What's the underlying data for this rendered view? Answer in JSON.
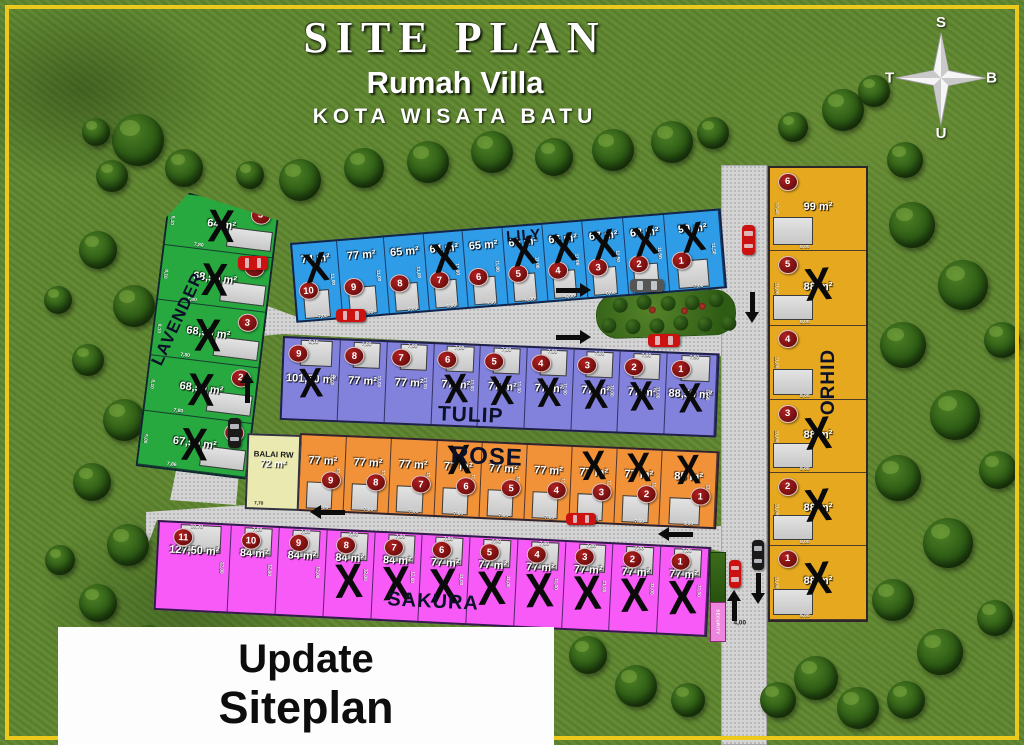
{
  "title": {
    "main": "SITE PLAN",
    "sub": "Rumah Villa",
    "location": "KOTA WISATA BATU"
  },
  "compass": {
    "top": "S",
    "bottom": "U",
    "left": "T",
    "right": "B"
  },
  "update_overlay": {
    "line1": "Update",
    "line2": "Siteplan"
  },
  "facility": {
    "name": "BALAI RW",
    "area": "72 m²",
    "frontage": "7,70"
  },
  "security_post_label": "SECURITY",
  "road_width_label": "4,00",
  "sold_marker": "X",
  "blocks": [
    {
      "id": "lily",
      "name": "LILY",
      "color": "#2f9ce8",
      "lots": [
        {
          "no": "10",
          "area": "74 m²",
          "sold": true,
          "f": "7,00",
          "d": "11,00"
        },
        {
          "no": "9",
          "area": "77 m²",
          "sold": false,
          "f": "7,00",
          "d": "11,00"
        },
        {
          "no": "8",
          "area": "65 m²",
          "sold": false,
          "f": "6,00",
          "d": "11,00"
        },
        {
          "no": "7",
          "area": "64 m²",
          "sold": true,
          "f": "6,00",
          "d": "11,00"
        },
        {
          "no": "6",
          "area": "65 m²",
          "sold": false,
          "f": "6,00",
          "d": "11,00"
        },
        {
          "no": "5",
          "area": "65 m²",
          "sold": true,
          "f": "6,00",
          "d": "11,00"
        },
        {
          "no": "4",
          "area": "66 m²",
          "sold": true,
          "f": "6,00",
          "d": "11,00"
        },
        {
          "no": "3",
          "area": "67 m²",
          "sold": true,
          "f": "6,00",
          "d": "11,50"
        },
        {
          "no": "2",
          "area": "68 m²",
          "sold": true,
          "f": "6,00",
          "d": "11,50"
        },
        {
          "no": "1",
          "area": "90 m²",
          "sold": true,
          "f": "7,00",
          "d": "11,50"
        }
      ]
    },
    {
      "id": "tulip",
      "name": "TULIP",
      "color": "#8282dd",
      "lots": [
        {
          "no": "9",
          "area": "101,50 m²",
          "sold": true,
          "f": "8,10",
          "d": "11,00"
        },
        {
          "no": "8",
          "area": "77 m²",
          "sold": false,
          "f": "7,00",
          "d": "11,00"
        },
        {
          "no": "7",
          "area": "77 m²",
          "sold": false,
          "f": "7,00",
          "d": "11,00"
        },
        {
          "no": "6",
          "area": "77 m²",
          "sold": true,
          "f": "7,00",
          "d": "11,00"
        },
        {
          "no": "5",
          "area": "77 m²",
          "sold": true,
          "f": "7,00",
          "d": "11,00"
        },
        {
          "no": "4",
          "area": "77 m²",
          "sold": true,
          "f": "7,00",
          "d": "11,00"
        },
        {
          "no": "3",
          "area": "77 m²",
          "sold": true,
          "f": "7,00",
          "d": "11,00"
        },
        {
          "no": "2",
          "area": "77 m²",
          "sold": true,
          "f": "7,00",
          "d": "11,00"
        },
        {
          "no": "1",
          "area": "88,50 m²",
          "sold": true,
          "f": "7,50",
          "d": "11,00"
        }
      ]
    },
    {
      "id": "rose",
      "name": "ROSE",
      "color": "#f29238",
      "lots": [
        {
          "no": "9",
          "area": "77 m²",
          "sold": false,
          "f": "7,00",
          "d": "11,00"
        },
        {
          "no": "8",
          "area": "77 m²",
          "sold": false,
          "f": "7,00",
          "d": "11,00"
        },
        {
          "no": "7",
          "area": "77 m²",
          "sold": false,
          "f": "7,00",
          "d": "11,00"
        },
        {
          "no": "6",
          "area": "77 m²",
          "sold": true,
          "f": "7,00",
          "d": "11,00"
        },
        {
          "no": "5",
          "area": "77 m²",
          "sold": false,
          "f": "7,00",
          "d": "11,00"
        },
        {
          "no": "4",
          "area": "77 m²",
          "sold": false,
          "f": "7,00",
          "d": "11,00"
        },
        {
          "no": "3",
          "area": "77 m²",
          "sold": true,
          "f": "7,00",
          "d": "11,00"
        },
        {
          "no": "2",
          "area": "77 m²",
          "sold": true,
          "f": "7,00",
          "d": "11,00"
        },
        {
          "no": "1",
          "area": "85 m²",
          "sold": true,
          "f": "8,00",
          "d": "11,00"
        }
      ]
    },
    {
      "id": "sakura",
      "name": "SAKURA",
      "color": "#f75af7",
      "lots": [
        {
          "no": "11",
          "area": "127,50 m²",
          "sold": false,
          "f": "10,70",
          "d": "12,00"
        },
        {
          "no": "10",
          "area": "84 m²",
          "sold": false,
          "f": "7,00",
          "d": "12,00"
        },
        {
          "no": "9",
          "area": "84 m²",
          "sold": false,
          "f": "7,00",
          "d": "12,00"
        },
        {
          "no": "8",
          "area": "84 m²",
          "sold": true,
          "f": "7,00",
          "d": "12,00"
        },
        {
          "no": "7",
          "area": "84 m²",
          "sold": true,
          "f": "7,00",
          "d": "12,00"
        },
        {
          "no": "6",
          "area": "77 m²",
          "sold": true,
          "f": "7,00",
          "d": "11,00"
        },
        {
          "no": "5",
          "area": "77 m²",
          "sold": true,
          "f": "7,00",
          "d": "11,00"
        },
        {
          "no": "4",
          "area": "77 m²",
          "sold": true,
          "f": "7,00",
          "d": "11,00"
        },
        {
          "no": "3",
          "area": "77 m²",
          "sold": true,
          "f": "7,00",
          "d": "11,00"
        },
        {
          "no": "2",
          "area": "77 m²",
          "sold": true,
          "f": "7,00",
          "d": "11,00"
        },
        {
          "no": "1",
          "area": "77 m²",
          "sold": true,
          "f": "7,00",
          "d": "11,00"
        }
      ]
    },
    {
      "id": "lavender",
      "name": "LAVENDER",
      "color": "#27a93f",
      "lots": [
        {
          "no": "5",
          "area": "64 m²",
          "sold": true,
          "f": "7,80",
          "d": "8,10"
        },
        {
          "no": "4",
          "area": "68,50 m²",
          "sold": true,
          "f": "7,80",
          "d": "8,10"
        },
        {
          "no": "3",
          "area": "68,50 m²",
          "sold": true,
          "f": "7,80",
          "d": "8,10"
        },
        {
          "no": "2",
          "area": "68,50 m²",
          "sold": true,
          "f": "7,80",
          "d": "8,10"
        },
        {
          "no": "1",
          "area": "67,50 m²",
          "sold": true,
          "f": "7,86",
          "d": "5,00"
        }
      ]
    },
    {
      "id": "orhid",
      "name": "ORHID",
      "color": "#e5a81f",
      "lots": [
        {
          "no": "6",
          "area": "99 m²",
          "sold": false,
          "f": "8,00",
          "d": "12,40"
        },
        {
          "no": "5",
          "area": "88 m²",
          "sold": true,
          "f": "8,00",
          "d": "11,00"
        },
        {
          "no": "4",
          "area": "",
          "sold": false,
          "f": "8,00",
          "d": "11,00"
        },
        {
          "no": "3",
          "area": "88 m²",
          "sold": true,
          "f": "8,00",
          "d": "11,00"
        },
        {
          "no": "2",
          "area": "88 m²",
          "sold": true,
          "f": "8,00",
          "d": "11,00"
        },
        {
          "no": "1",
          "area": "88 m²",
          "sold": true,
          "f": "9,00",
          "d": "11,00"
        }
      ]
    }
  ]
}
